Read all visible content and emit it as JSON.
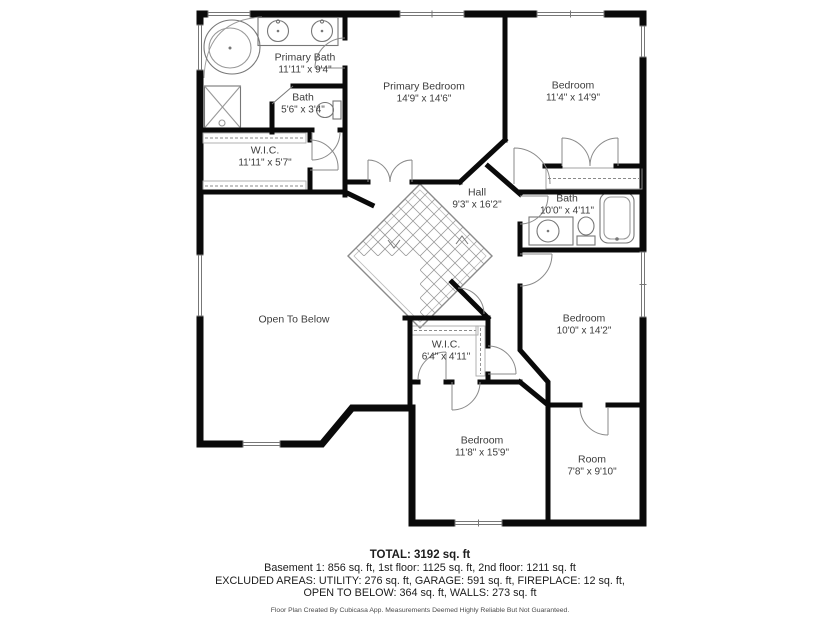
{
  "rooms": [
    {
      "id": "primary-bath",
      "name": "Primary Bath",
      "dims": "11'11\" x 9'4\""
    },
    {
      "id": "bath-1",
      "name": "Bath",
      "dims": "5'6\" x 3'4\""
    },
    {
      "id": "wic-1",
      "name": "W.I.C.",
      "dims": "11'11\" x 5'7\""
    },
    {
      "id": "primary-bedroom",
      "name": "Primary Bedroom",
      "dims": "14'9\" x 14'6\""
    },
    {
      "id": "bedroom-top-right",
      "name": "Bedroom",
      "dims": "11'4\" x 14'9\""
    },
    {
      "id": "hall",
      "name": "Hall",
      "dims": "9'3\" x 16'2\""
    },
    {
      "id": "bath-2",
      "name": "Bath",
      "dims": "10'0\" x 4'11\""
    },
    {
      "id": "open-to-below",
      "name": "Open To Below",
      "dims": ""
    },
    {
      "id": "wic-2",
      "name": "W.I.C.",
      "dims": "6'4\" x 4'11\""
    },
    {
      "id": "bedroom-middle",
      "name": "Bedroom",
      "dims": "10'0\" x 14'2\""
    },
    {
      "id": "bedroom-bottom",
      "name": "Bedroom",
      "dims": "11'8\" x 15'9\""
    },
    {
      "id": "room",
      "name": "Room",
      "dims": "7'8\" x 9'10\""
    }
  ],
  "summary": {
    "total": "TOTAL: 3192 sq. ft",
    "floors": "Basement 1: 856 sq. ft, 1st floor: 1125 sq. ft, 2nd floor: 1211 sq. ft",
    "excluded1": "EXCLUDED AREAS: UTILITY: 276 sq. ft, GARAGE: 591 sq. ft, FIREPLACE: 12 sq. ft,",
    "excluded2": "OPEN TO BELOW: 364 sq. ft, WALLS: 273 sq. ft",
    "disclaimer": "Floor Plan Created By Cubicasa App. Measurements Deemed Highly Reliable But Not Guaranteed."
  }
}
